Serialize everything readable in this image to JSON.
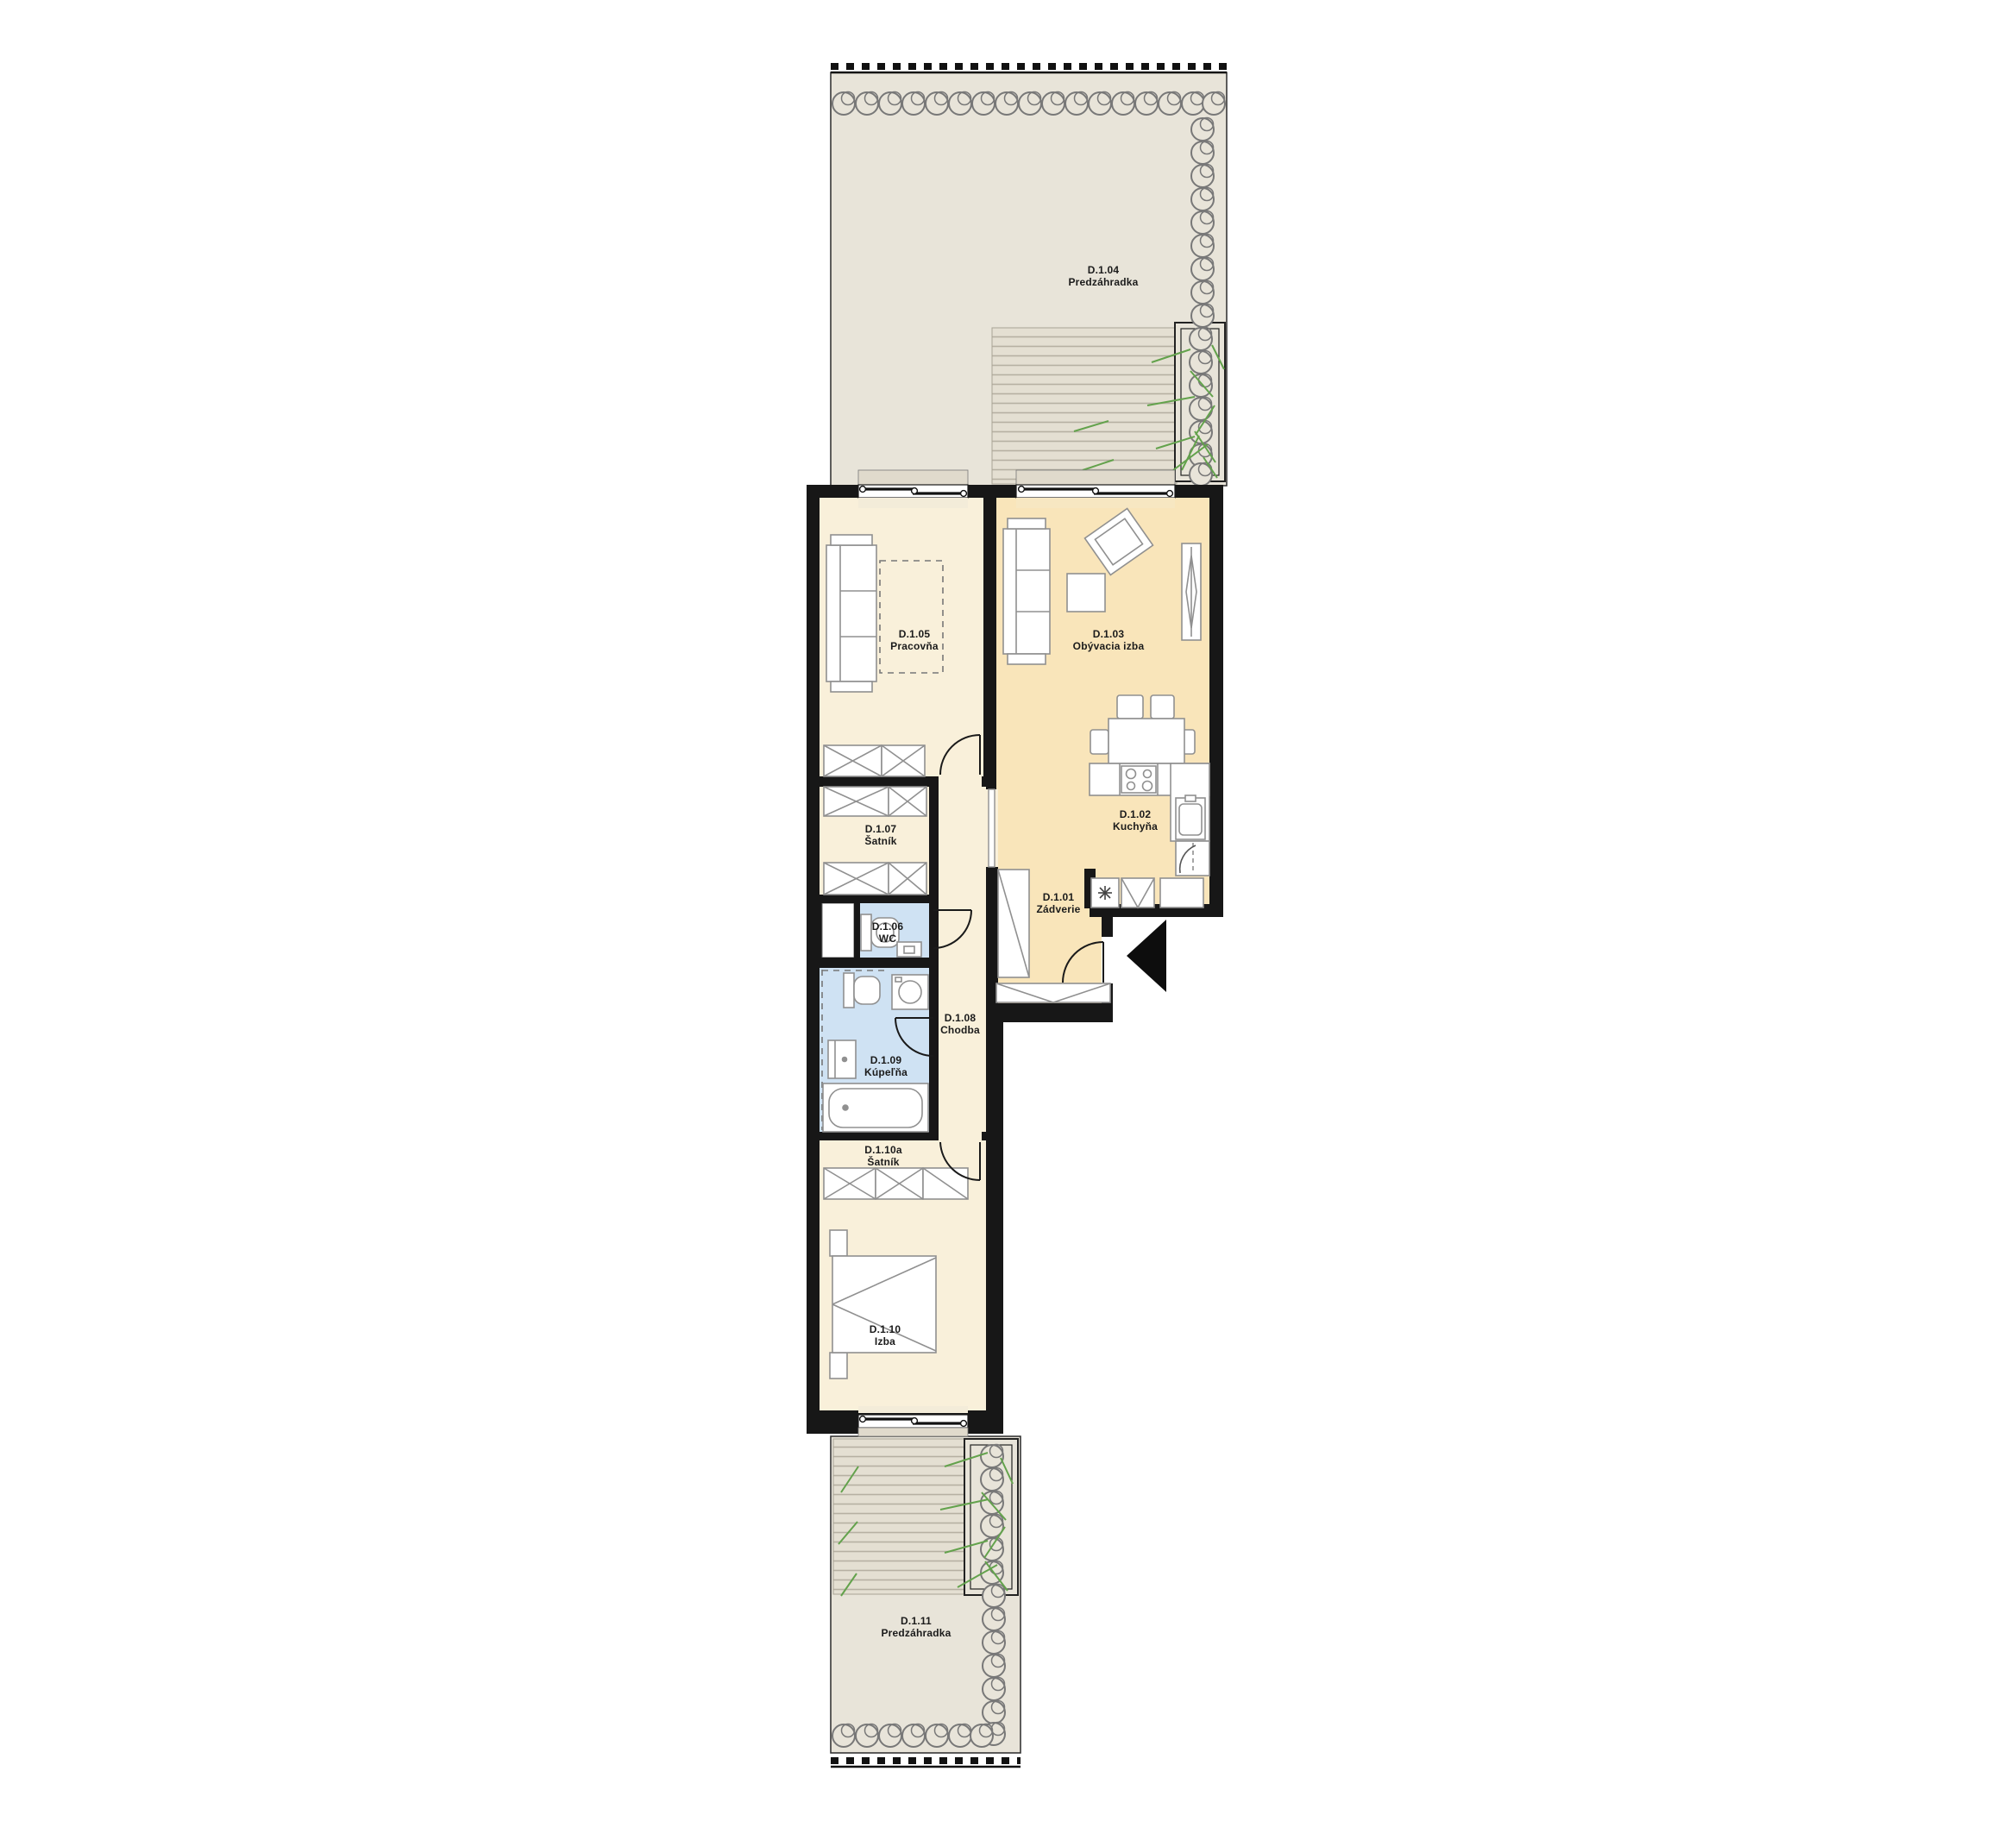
{
  "plan": {
    "type": "apartment-floorplan",
    "unit_prefix": "D.1",
    "language": "sk"
  },
  "rooms": [
    {
      "id": "D.1.01",
      "name": "Zádverie"
    },
    {
      "id": "D.1.02",
      "name": "Kuchyňa"
    },
    {
      "id": "D.1.03",
      "name": "Obývacia izba"
    },
    {
      "id": "D.1.04",
      "name": "Predzáhradka"
    },
    {
      "id": "D.1.05",
      "name": "Pracovňa"
    },
    {
      "id": "D.1.06",
      "name": "WC"
    },
    {
      "id": "D.1.07",
      "name": "Šatník"
    },
    {
      "id": "D.1.08",
      "name": "Chodba"
    },
    {
      "id": "D.1.09",
      "name": "Kúpeľňa"
    },
    {
      "id": "D.1.10",
      "name": "Izba"
    },
    {
      "id": "D.1.10a",
      "name": "Šatník"
    },
    {
      "id": "D.1.11",
      "name": "Predzáhradka"
    }
  ],
  "colors": {
    "wall": "#171717",
    "room_warm": "#f9f0da",
    "room_accent": "#f9e5ba",
    "room_wet": "#cfe2f3",
    "garden": "#e8e4d9",
    "deck_line": "#b6b0a2",
    "furniture_stroke": "#909090",
    "shrub_stroke": "#787878",
    "grass": "#63a24c"
  }
}
